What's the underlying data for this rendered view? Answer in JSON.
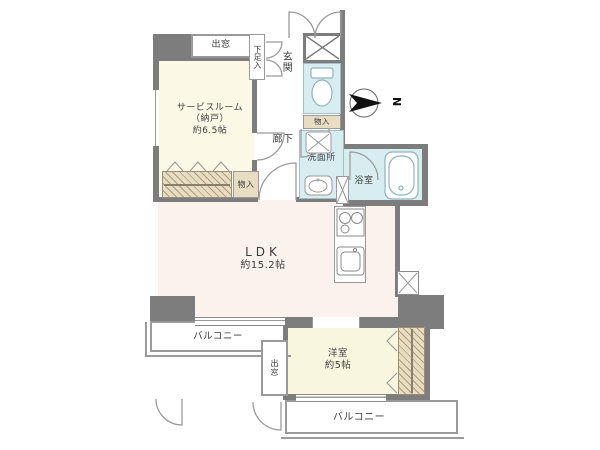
{
  "compass": {
    "north_label": "N"
  },
  "colors": {
    "wall": "#7d7d7d",
    "wet_area_fill": "#d7edf0",
    "service_room_fill": "#fcf8e6",
    "ldk_fill": "#fbf1ed",
    "western_room_fill": "#f8f6df",
    "storage_fill": "#e8dcc2"
  },
  "labels": {
    "bay_window_top": "出窓",
    "shoe_cabinet": "下足入",
    "entrance": "玄関",
    "service_room_name": "サービスルーム",
    "service_room_sub": "（納戸）",
    "service_room_size": "約6.5帖",
    "corridor": "廊下",
    "storage_by_toilet": "物入",
    "washroom": "洗面所",
    "bathroom": "浴室",
    "storage_hall": "物入",
    "ldk_name": "LDK",
    "ldk_size": "約15.2帖",
    "balcony_left": "バルコニー",
    "western_room_name": "洋室",
    "western_room_size": "約5帖",
    "bay_window_bottom": "出窓",
    "balcony_bottom": "バルコニー"
  }
}
